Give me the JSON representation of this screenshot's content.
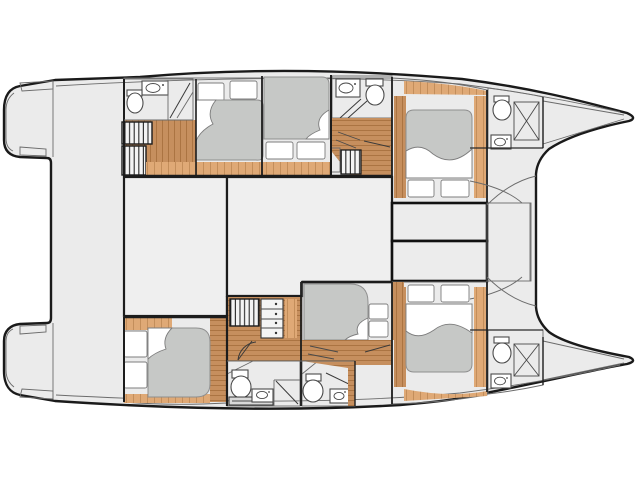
{
  "diagram": {
    "type": "yacht-deck-plan",
    "subject": "catamaran lower-deck layout, bow to the right, twin hulls with central bridgedeck",
    "cabin_count": 6,
    "bathroom_count": 6,
    "features": {
      "port_hull": [
        "aft-head-with-shower",
        "aft-double-cabin",
        "mid-double-cabin",
        "mid-head",
        "companionway-steps",
        "forward-double-cabin",
        "forward-head",
        "bow-locker"
      ],
      "starboard_hull": [
        "aft-double-cabin",
        "companionway-steps",
        "dresser",
        "aft-head-with-shower",
        "mid-head",
        "mid-berth-cabin",
        "forward-double-cabin",
        "forward-head",
        "bow-locker"
      ],
      "bridgedeck": [
        "aft-cockpit",
        "saloon",
        "saloon-annex",
        "foredeck-lockers",
        "forward-crossbeam",
        "trampoline-notch"
      ],
      "stern": [
        "port-transom-steps",
        "starboard-transom-steps"
      ]
    }
  },
  "colors": {
    "background": "#ffffff",
    "deck": "#ebebeb",
    "saloon": "#efefef",
    "cabin": "#f6f6f6",
    "bathroom": "#fafafa",
    "foredeck_box": "#ececec",
    "beam_strip": "#e9e9e9",
    "wood_floor": "#c68f5e",
    "wood_floor_line": "#a8713f",
    "wood_light": "#dfa976",
    "wood_light_line": "#c08b58",
    "mattress": "#c6c8c6",
    "mattress_border": "#8f8f8f",
    "linen": "#ffffff",
    "counter": "#d9d9d9",
    "outline": "#1a1a1a",
    "step_stripe": "#2a2a2a"
  }
}
